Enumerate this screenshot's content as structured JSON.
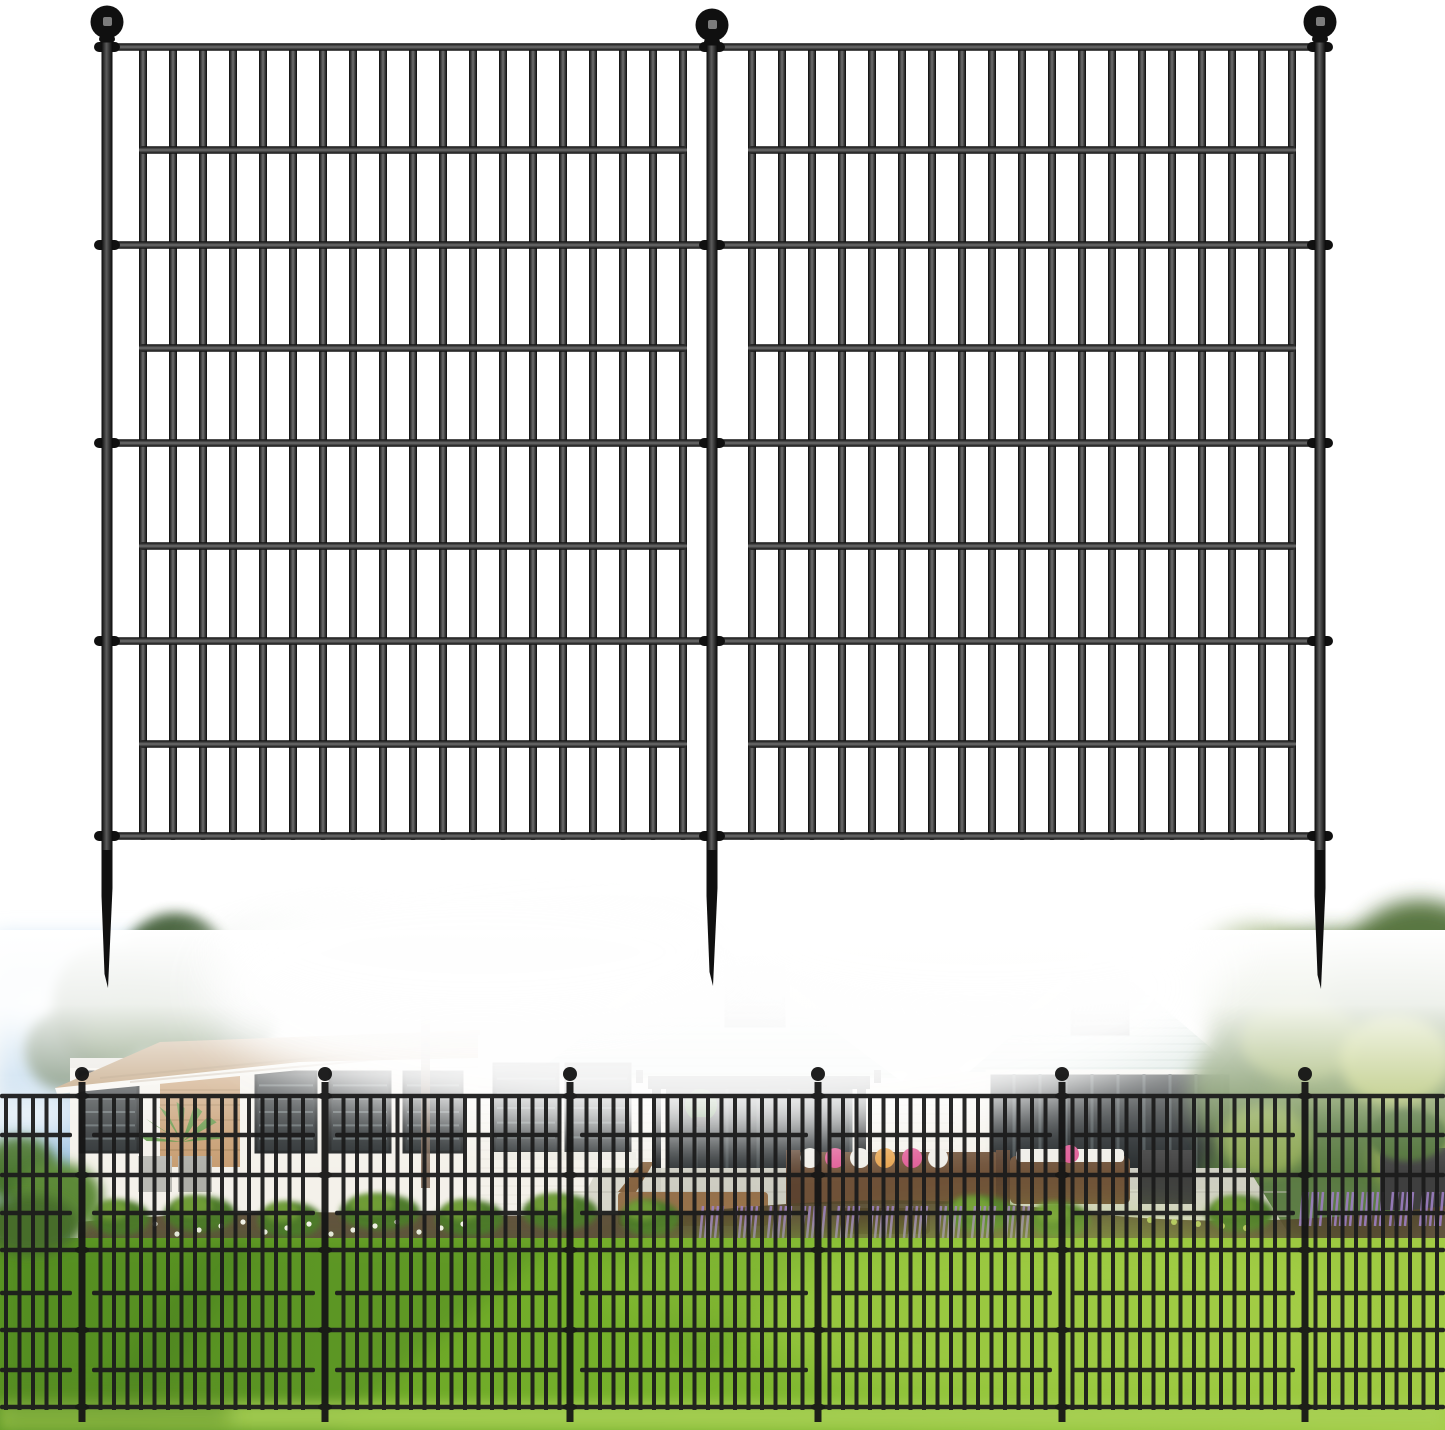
{
  "scene": {
    "description": "Product image: two connected black metal no-dig garden fence panels with ball-top posts and ground spikes, displayed above a fading photo of a backyard — a white-brick house with seafoam gable siding, green lawn, patio furniture, flower beds, trees, and the same fence installed in a row",
    "canvas": {
      "width": 1445,
      "height": 1430,
      "background": "#ffffff"
    }
  },
  "palette": {
    "fence_black": "#101010",
    "fence_sheen": "#6e6e6e",
    "ball_glint": "#8f8f8f",
    "photo_fence_black": "#1c1c1c",
    "sky_top": "#cfe4f4",
    "sky_bottom": "#8fb9dd",
    "cloud_white": "#ffffff",
    "pine_green": "#44603b",
    "canopy_faded": "#aebfae",
    "trunk_brown": "#7a6350",
    "roof_tan": "#b5906tan",
    "roof_tan_fix": "#b59064",
    "fascia_white": "#f6f4ee",
    "wall_white": "#f4f1ea",
    "wall_shadow": "#d9d6cd",
    "siding_seafoam": "#cdddd7",
    "siding_line": "#aec5bd",
    "trim_white": "#fbfbf9",
    "window_dark": "#272c2e",
    "window_slat": "#7d8a8c",
    "brick_tan": "#c59a6d",
    "mulch_brown": "#55462f",
    "shrub_green": "#4e7a2c",
    "shrub_light": "#74a238",
    "lavender": "#9d7fc2",
    "flower_white": "#f4f4ea",
    "patio_gray": "#d6d5c9",
    "paver_line": "#bdbcb0",
    "wood_brown": "#96714b",
    "wicker_brown": "#6f5138",
    "wicker_dark": "#5d4330",
    "pillow_pink": "#e05a95",
    "pillow_orange": "#e8a34c",
    "pillow_white": "#f0eee8",
    "planter_dark": "#3f3f3f",
    "lawn_dark": "#5f9a23",
    "lawn_mid": "#74af2a",
    "lawn_bright": "#8cc136",
    "lawn_edge": "#a3cc45",
    "lawn_shadow": "#35691a",
    "foreground_grass": "#a9d055",
    "hedge_green": "#5d7c40",
    "hedge_dark": "#516f38",
    "hedge_light": "#94ab52",
    "hedge_yellow": "#bac968"
  },
  "product_fence": {
    "finish": "matte black steel wire",
    "posts": [
      {
        "x": 107,
        "ball_cy": 22,
        "spike_tip_y": 988
      },
      {
        "x": 712,
        "ball_cy": 25,
        "spike_tip_y": 986
      },
      {
        "x": 1320,
        "ball_cy": 22,
        "spike_tip_y": 989
      }
    ],
    "post_width": 11,
    "post_top_y": 36,
    "ball_radius": 16.5,
    "panels": [
      {
        "first_bar_x": 143,
        "last_bar_x": 683
      },
      {
        "first_bar_x": 752,
        "last_bar_x": 1292
      }
    ],
    "bars_per_panel": 19,
    "bar_pitch": 30,
    "bar_width": 8,
    "bar_top_y": 47,
    "bar_bottom_y": 840,
    "rails_full_y": [
      47,
      245,
      443,
      641,
      836
    ],
    "rails_inset_y": [
      150,
      348,
      546,
      744
    ],
    "rail_thickness": 7.5,
    "inset_overhang": 4
  },
  "photo": {
    "top_y": 930,
    "fade_end_y": 1178,
    "fence": {
      "posts_x": [
        82,
        325,
        570,
        818,
        1062,
        1305
      ],
      "ball_cy": 1074,
      "ball_radius": 7,
      "post_width": 7,
      "post_top_y": 1082,
      "post_bottom_y": 1422,
      "bar_pitch": 13.5,
      "bar_width": 4,
      "bar_top_y": 1096,
      "bar_bottom_y": 1410,
      "rails_full_y": [
        1096,
        1175,
        1250,
        1330,
        1407
      ],
      "rails_inset_y": [
        1135,
        1213,
        1293,
        1370
      ],
      "rail_thickness": 4.5
    }
  }
}
